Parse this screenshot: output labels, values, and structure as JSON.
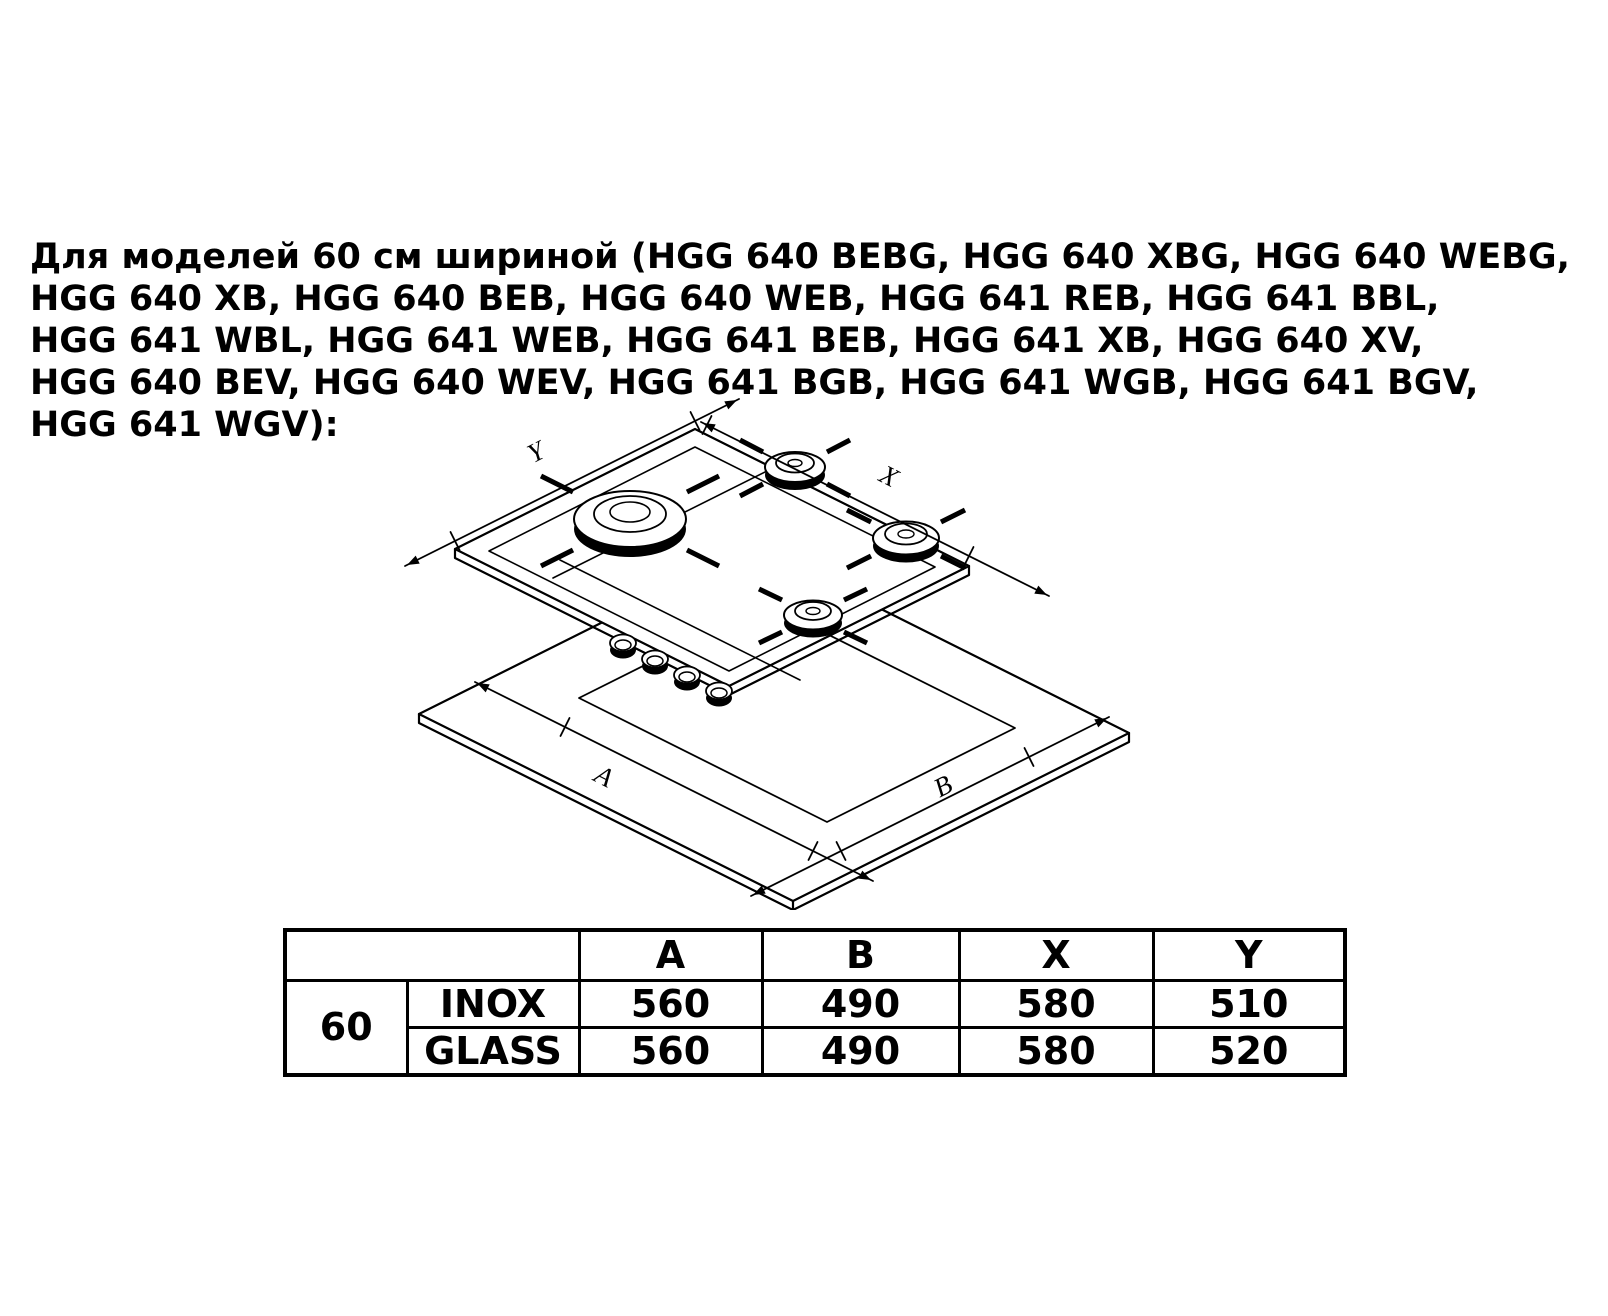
{
  "intro": {
    "lines": [
      "Для моделей 60 см шириной (HGG 640 BEBG, HGG 640 XBG, HGG 640 WEBG,",
      "HGG 640 XB, HGG 640 BEB, HGG 640 WEB, HGG 641 REB, HGG 641 BBL,",
      "HGG 641 WBL, HGG 641 WEB, HGG 641 BEB, HGG 641 XB, HGG 640 XV,",
      "HGG 640 BEV, HGG 640 WEV, HGG 641 BGB, HGG 641 WGB, HGG 641 BGV,",
      "HGG 641 WGV):"
    ]
  },
  "diagram": {
    "labels": {
      "a": "A",
      "b": "B",
      "x": "X",
      "y": "Y"
    }
  },
  "table": {
    "headers": {
      "a": "A",
      "b": "B",
      "x": "X",
      "y": "Y"
    },
    "width_label": "60",
    "rows": [
      {
        "finish": "INOX",
        "a": "560",
        "b": "490",
        "x": "580",
        "y": "510"
      },
      {
        "finish": "GLASS",
        "a": "560",
        "b": "490",
        "x": "580",
        "y": "520"
      }
    ]
  }
}
